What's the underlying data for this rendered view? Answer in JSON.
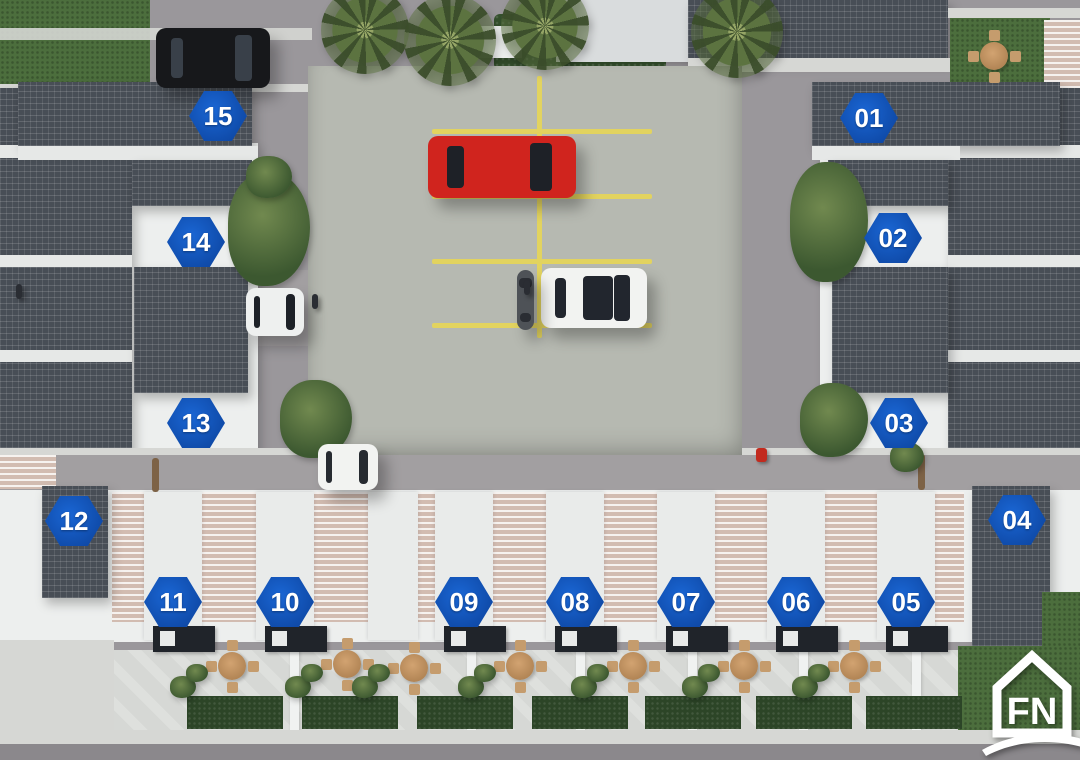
{
  "logo": {
    "text": "FN",
    "description": "white house-outline logo with swoosh",
    "color": "#ffffff"
  },
  "site_plan": {
    "badge_shape": "hexagon",
    "badge_color": "#0f4aa8",
    "badge_text_color": "#ffffff",
    "units": [
      {
        "number": "01",
        "x": 869,
        "y": 118
      },
      {
        "number": "02",
        "x": 893,
        "y": 238
      },
      {
        "number": "03",
        "x": 899,
        "y": 423
      },
      {
        "number": "04",
        "x": 1017,
        "y": 520
      },
      {
        "number": "05",
        "x": 906,
        "y": 602
      },
      {
        "number": "06",
        "x": 796,
        "y": 602
      },
      {
        "number": "07",
        "x": 686,
        "y": 602
      },
      {
        "number": "08",
        "x": 575,
        "y": 602
      },
      {
        "number": "09",
        "x": 464,
        "y": 602
      },
      {
        "number": "10",
        "x": 285,
        "y": 602
      },
      {
        "number": "11",
        "x": 173,
        "y": 602
      },
      {
        "number": "12",
        "x": 74,
        "y": 521
      },
      {
        "number": "13",
        "x": 196,
        "y": 423
      },
      {
        "number": "14",
        "x": 196,
        "y": 242
      },
      {
        "number": "15",
        "x": 218,
        "y": 116
      }
    ]
  },
  "parking_lot": {
    "surface_color": "#b6b9b1",
    "line_color": "#e2d35f",
    "stall_divider_rows": 4,
    "center_line": true
  },
  "scene": {
    "palm_trees": [
      {
        "x": 365,
        "y": 30,
        "r": 44
      },
      {
        "x": 450,
        "y": 40,
        "r": 46
      },
      {
        "x": 545,
        "y": 26,
        "r": 44
      },
      {
        "x": 737,
        "y": 32,
        "r": 46
      }
    ],
    "patio_tables": [
      {
        "x": 232,
        "y": 666
      },
      {
        "x": 347,
        "y": 664
      },
      {
        "x": 414,
        "y": 668
      },
      {
        "x": 520,
        "y": 666
      },
      {
        "x": 633,
        "y": 666
      },
      {
        "x": 744,
        "y": 666
      },
      {
        "x": 854,
        "y": 666
      },
      {
        "x": 994,
        "y": 56
      }
    ],
    "vehicles": [
      {
        "name": "black-suv",
        "x": 156,
        "y": 28,
        "w": 114,
        "h": 60,
        "body": "#17181b",
        "glass": "#394049",
        "dir": "h",
        "sunroof": false
      },
      {
        "name": "red-sedan",
        "x": 428,
        "y": 136,
        "w": 148,
        "h": 62,
        "body": "#d0241e",
        "glass": "#1e2127",
        "dir": "h",
        "sunroof": false
      },
      {
        "name": "white-hatchback",
        "x": 541,
        "y": 268,
        "w": 106,
        "h": 60,
        "body": "#f2f3f1",
        "glass": "#22262e",
        "dir": "h",
        "sunroof": true
      },
      {
        "name": "motorcycle",
        "x": 517,
        "y": 270,
        "w": 17,
        "h": 60,
        "body": "#4e5257",
        "glass": "#2a2d33",
        "dir": "v",
        "sunroof": false
      },
      {
        "name": "white-car-entrance",
        "x": 246,
        "y": 288,
        "w": 58,
        "h": 48,
        "body": "#eef0ef",
        "glass": "#1d2127",
        "dir": "h",
        "sunroof": false
      },
      {
        "name": "white-car-road",
        "x": 318,
        "y": 444,
        "w": 60,
        "h": 46,
        "body": "#f2f3f1",
        "glass": "#272b31",
        "dir": "h",
        "sunroof": false
      }
    ],
    "people": [
      {
        "x": 16,
        "y": 284
      },
      {
        "x": 312,
        "y": 294
      },
      {
        "x": 524,
        "y": 280
      }
    ],
    "foliage": [
      {
        "x": 228,
        "y": 172,
        "w": 82,
        "h": 114
      },
      {
        "x": 246,
        "y": 156,
        "w": 46,
        "h": 42
      },
      {
        "x": 280,
        "y": 380,
        "w": 72,
        "h": 78
      },
      {
        "x": 790,
        "y": 162,
        "w": 78,
        "h": 120
      },
      {
        "x": 800,
        "y": 383,
        "w": 68,
        "h": 74
      },
      {
        "x": 890,
        "y": 442,
        "w": 34,
        "h": 30
      },
      {
        "x": 170,
        "y": 676,
        "w": 26,
        "h": 22
      },
      {
        "x": 186,
        "y": 664,
        "w": 22,
        "h": 18
      },
      {
        "x": 285,
        "y": 676,
        "w": 26,
        "h": 22
      },
      {
        "x": 301,
        "y": 664,
        "w": 22,
        "h": 18
      },
      {
        "x": 352,
        "y": 676,
        "w": 26,
        "h": 22
      },
      {
        "x": 368,
        "y": 664,
        "w": 22,
        "h": 18
      },
      {
        "x": 458,
        "y": 676,
        "w": 26,
        "h": 22
      },
      {
        "x": 474,
        "y": 664,
        "w": 22,
        "h": 18
      },
      {
        "x": 571,
        "y": 676,
        "w": 26,
        "h": 22
      },
      {
        "x": 587,
        "y": 664,
        "w": 22,
        "h": 18
      },
      {
        "x": 682,
        "y": 676,
        "w": 26,
        "h": 22
      },
      {
        "x": 698,
        "y": 664,
        "w": 22,
        "h": 18
      },
      {
        "x": 792,
        "y": 676,
        "w": 26,
        "h": 22
      },
      {
        "x": 808,
        "y": 664,
        "w": 22,
        "h": 18
      }
    ],
    "grass_patches": [
      {
        "x": 187,
        "y": 696,
        "w": 96,
        "h": 33
      },
      {
        "x": 302,
        "y": 696,
        "w": 96,
        "h": 33
      },
      {
        "x": 417,
        "y": 696,
        "w": 96,
        "h": 33
      },
      {
        "x": 532,
        "y": 696,
        "w": 96,
        "h": 33
      },
      {
        "x": 645,
        "y": 696,
        "w": 96,
        "h": 33
      },
      {
        "x": 756,
        "y": 696,
        "w": 96,
        "h": 33
      },
      {
        "x": 866,
        "y": 696,
        "w": 96,
        "h": 33
      }
    ]
  },
  "colors": {
    "asphalt": "#9a979b",
    "dark_roof": "#484e56",
    "light_roof": "#d9dcdd",
    "white_wall": "#edefee",
    "grass": "#4c6e3d",
    "pergola": "#d2bcb1",
    "patio": "#d6d8d5"
  }
}
